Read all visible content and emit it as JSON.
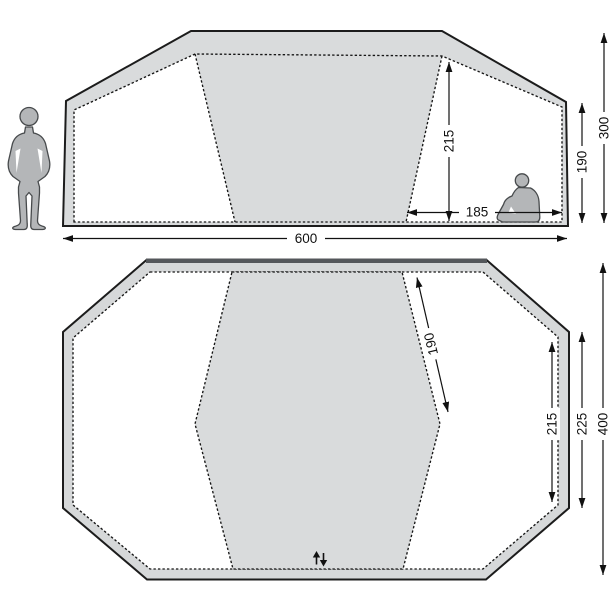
{
  "diagram": {
    "type": "tent-dimensions",
    "background": "#ffffff",
    "colors": {
      "tent_fill": "#d9dbdc",
      "plan_ring_fill": "#d6d8d9",
      "panel_fill": "#ffffff",
      "outline": "#1c1c1c",
      "dashed_line": "#151515",
      "dimension_line": "#111111",
      "person_fill": "#b4b6b8",
      "person_outline": "#474a4c",
      "plan_front_edge": "#54575b"
    },
    "icons": {
      "standing_person": "standing-person-silhouette",
      "seated_person": "seated-person-silhouette",
      "door_zipper": "zipper-arrows-icon"
    },
    "side_view": {
      "labels": {
        "inner_height": "215",
        "inner_width": "185",
        "side_wall_height": "190",
        "total_height": "300",
        "total_width": "600"
      }
    },
    "floor_plan": {
      "labels": {
        "cabin_diagonal": "190",
        "inner_cabin_depth": "215",
        "outer_cabin_depth": "225",
        "total_depth": "400"
      }
    }
  }
}
